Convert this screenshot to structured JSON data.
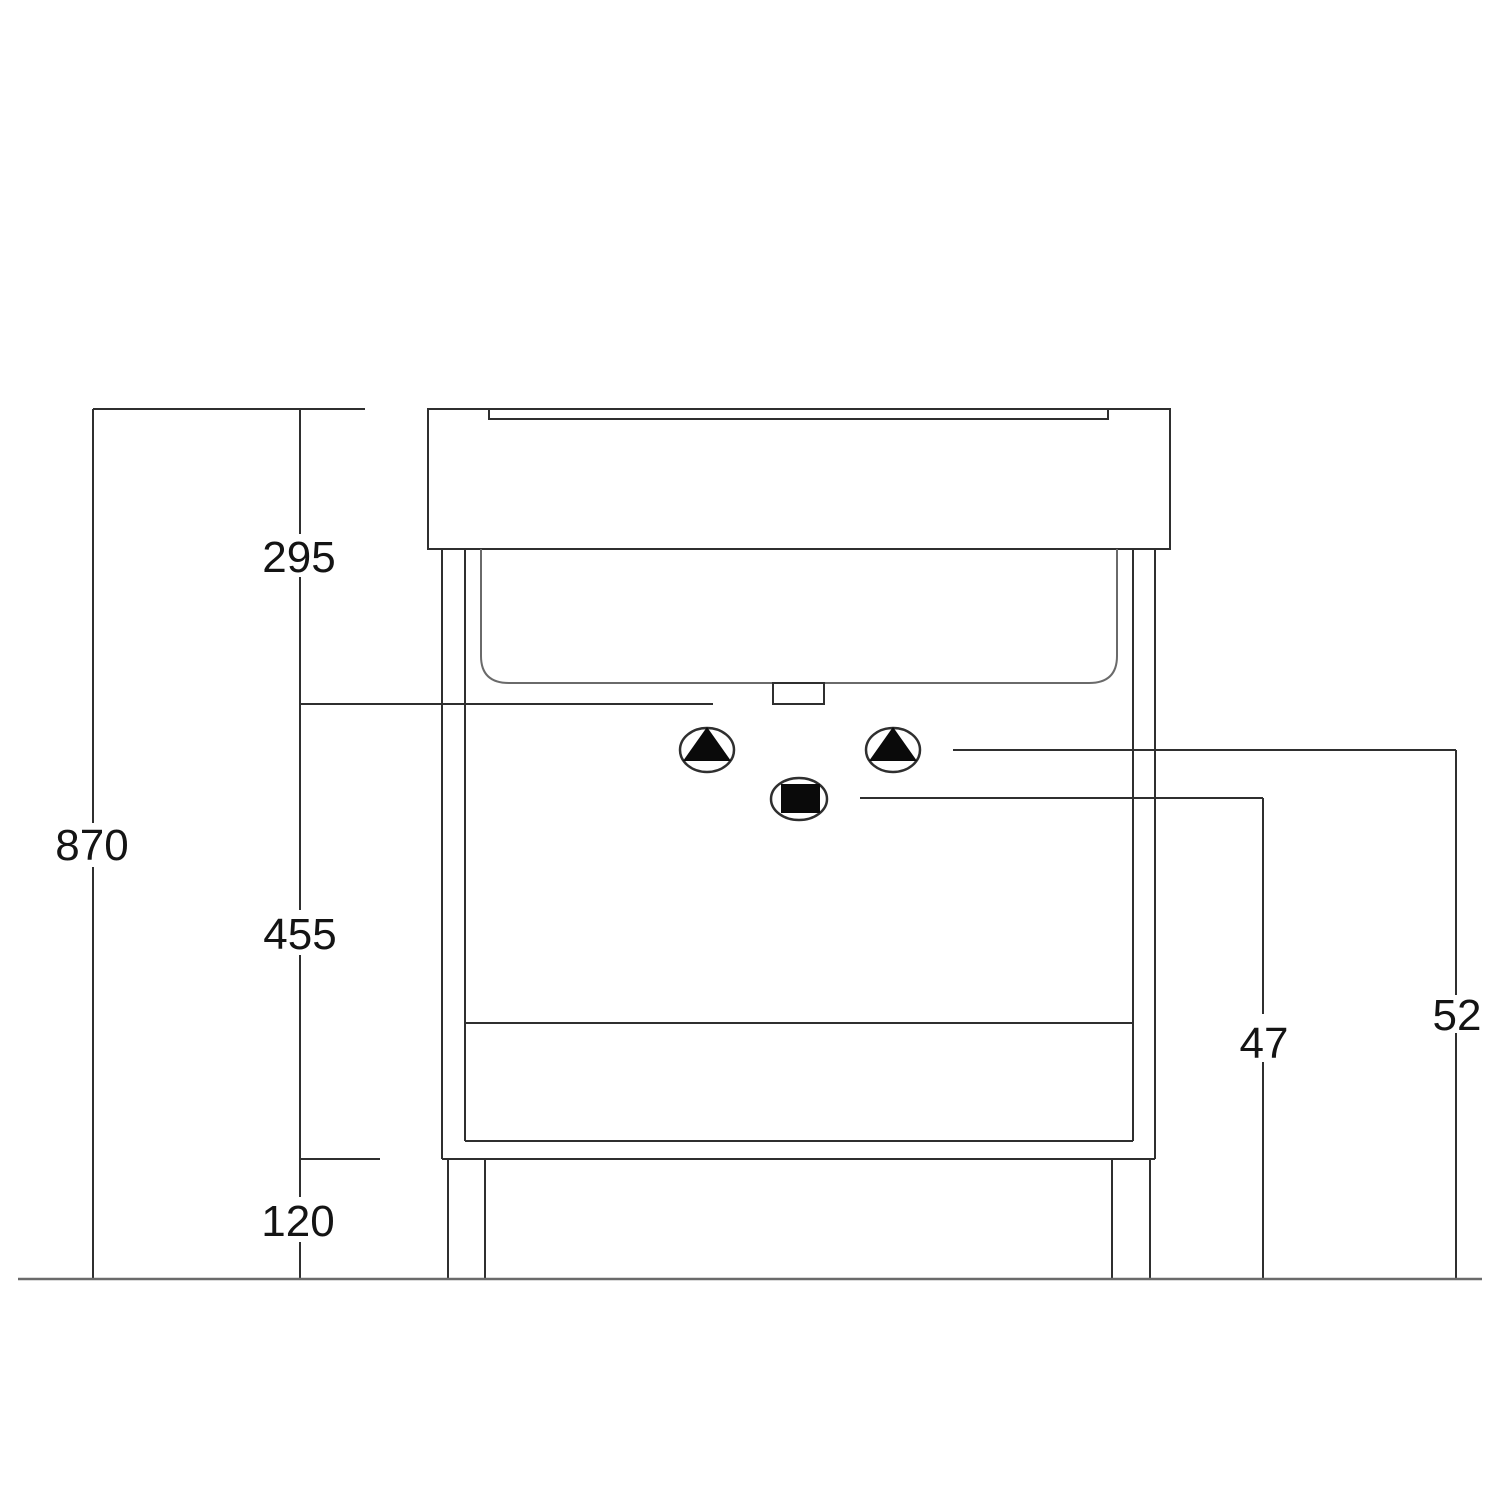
{
  "labels": {
    "total_height": "870",
    "top_section_height": "295",
    "middle_section_height": "455",
    "leg_height": "120",
    "waste_outlet_offset": "47",
    "supply_offset": "52"
  },
  "symbols": {
    "left_supply": "triangle-in-circle",
    "right_supply": "triangle-in-circle",
    "waste_outlet": "square-in-circle"
  },
  "colors": {
    "line": "#2f2f2f",
    "secondary_line": "#6a6a6a",
    "symbol_fill": "#0a0a0a",
    "text": "#141414",
    "background": "#ffffff"
  }
}
